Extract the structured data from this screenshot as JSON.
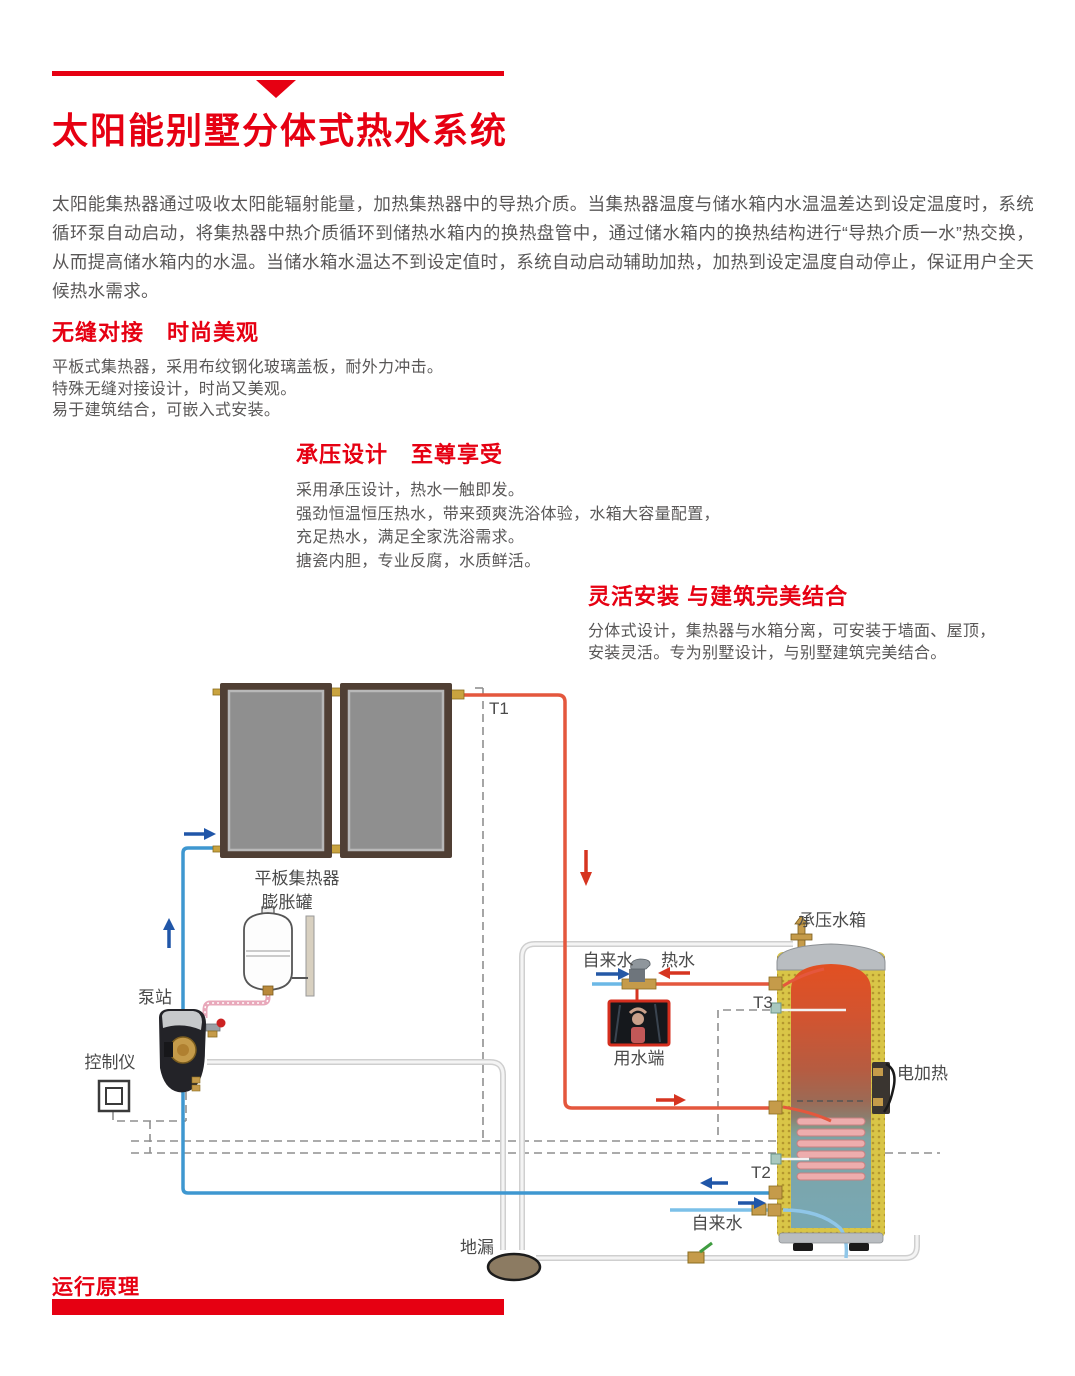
{
  "page": {
    "title": "太阳能别墅分体式热水系统",
    "intro": "太阳能集热器通过吸收太阳能辐射能量，加热集热器中的导热介质。当集热器温度与储水箱内水温温差达到设定温度时，系统循环泵自动启动，将集热器中热介质循环到储热水箱内的换热盘管中，通过储水箱内的换热结构进行“导热介质一水”热交换，从而提高储水箱内的水温。当储水箱水温达不到设定值时，系统自动启动辅助加热，加热到设定温度自动停止，保证用户全天候热水需求。",
    "sections": [
      {
        "heading": "无缝对接　时尚美观",
        "lines": [
          "平板式集热器，采用布纹钢化玻璃盖板，耐外力冲击。",
          "特殊无缝对接设计，时尚又美观。",
          "易于建筑结合，可嵌入式安装。"
        ]
      },
      {
        "heading": "承压设计　至尊享受",
        "lines": [
          "采用承压设计，热水一触即发。",
          "强劲恒温恒压热水，带来颈爽洗浴体验，水箱大容量配置，",
          "充足热水，满足全家洗浴需求。",
          "搪瓷内胆，专业反腐，水质鲜活。"
        ]
      },
      {
        "heading": "灵活安装 与建筑完美结合",
        "lines": [
          "分体式设计，集热器与水箱分离，可安装于墙面、屋顶，",
          "安装灵活。专为别墅设计，与别墅建筑完美结合。"
        ]
      }
    ],
    "footer_heading": "运行原理"
  },
  "diagram": {
    "labels": {
      "collector": "平板集热器",
      "expansion_tank": "膨胀罐",
      "pump_station": "泵站",
      "controller": "控制仪",
      "sensor_t1": "T1",
      "sensor_t2": "T2",
      "sensor_t3": "T3",
      "tap_water_top": "自来水",
      "hot_water": "热水",
      "water_outlet": "用水端",
      "pressure_tank": "承压水箱",
      "electric_heater": "电加热",
      "tap_water_bottom": "自来水",
      "floor_drain": "地漏"
    }
  },
  "colors": {
    "accent_red": "#e60012",
    "body_text": "#595757",
    "pipe_hot": "#e4573d",
    "pipe_cold": "#3e97d0",
    "pipe_tap": "#7cc0e8",
    "pipe_drain": "#e3e3e3",
    "pipe_expansion": "#e8a8ba",
    "arrow_blue": "#2056a8",
    "arrow_red": "#d63420",
    "tank_insulation": "#d9c547"
  }
}
